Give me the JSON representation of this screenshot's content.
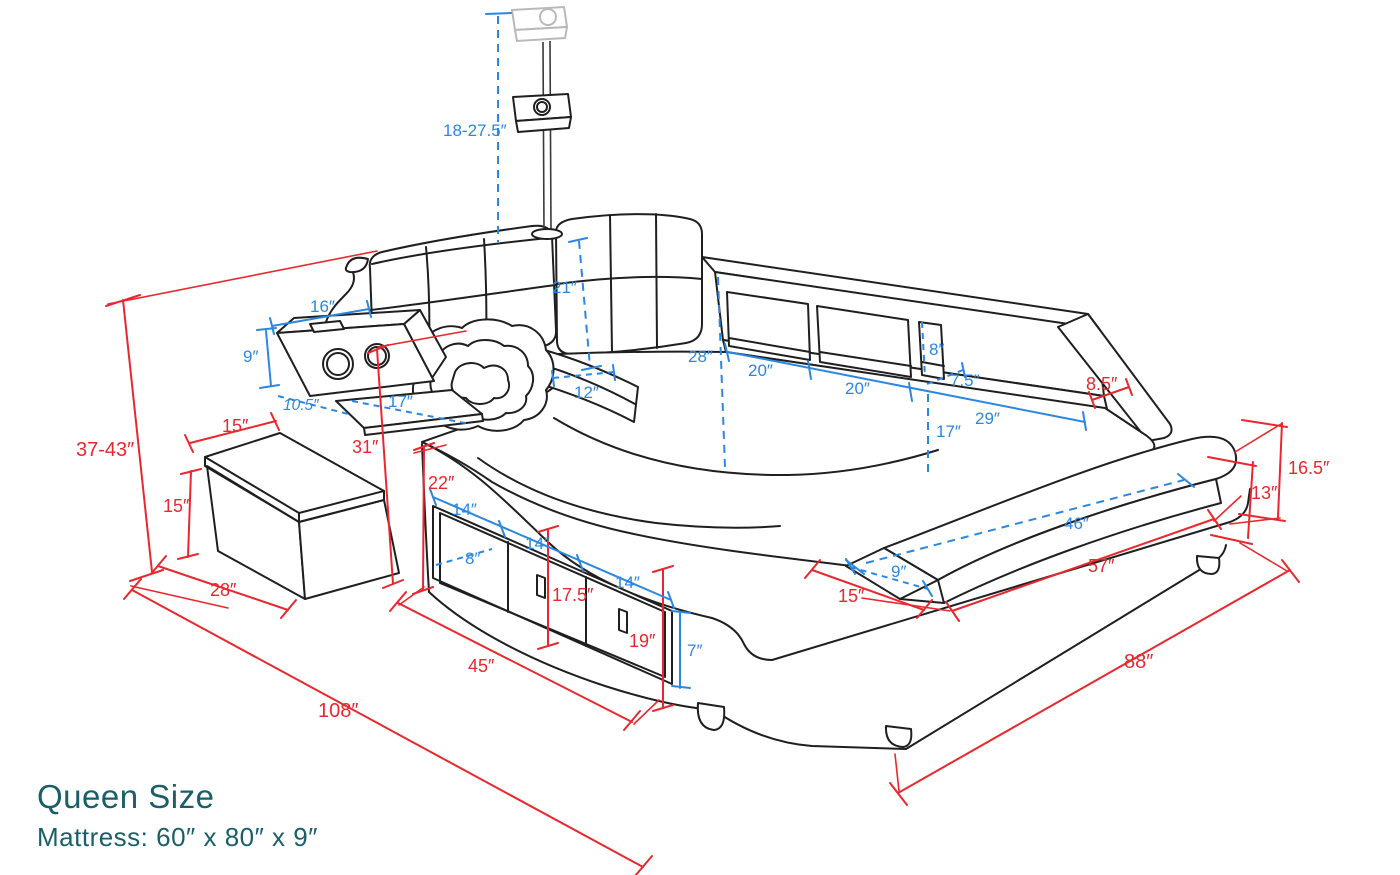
{
  "title": {
    "product": "Queen Size",
    "mattress_spec": "Mattress:  60″  x  80″  x  9″"
  },
  "colors": {
    "dimension_red": "#e8282e",
    "dimension_blue": "#2b87e1",
    "title_teal": "#1a5f68",
    "line_black": "#1f1f1f"
  },
  "dims_blue": {
    "projector_drop": "18-27.5″",
    "headboard_cushion_height": "21″",
    "speaker_shelf_width": "16″",
    "speaker_shelf_height": "9″",
    "speaker_shelf_depth": "10.5″",
    "side_tray_depth": "17″",
    "headrest_width": "12″",
    "mattress_head_width": "28″",
    "shelf_section_1": "20″",
    "shelf_section_2": "20″",
    "cubby_height": "8″",
    "shelf_depth": "7.5″",
    "shelf_section_3": "29″",
    "rail_height": "17″",
    "bench_top_length": "46″",
    "bench_depth": "9″",
    "plinth_height": "7″",
    "drawer_1": "14″",
    "drawer_2": "14″",
    "drawer_3": "14″",
    "drawer_depth": "8″"
  },
  "dims_red": {
    "total_height": "37-43″",
    "ottoman_width": "15″",
    "ottoman_height": "15″",
    "ottoman_depth": "28″",
    "total_length": "108″",
    "side_table_height": "31″",
    "mattress_left_width": "22″",
    "drawer_panel_height": "17.5″",
    "base_height": "19″",
    "drawer_unit_length": "45″",
    "front_gap": "15″",
    "bench_length": "57″",
    "total_width": "88″",
    "rail_top_width": "8.5″",
    "corner_height": "16.5″",
    "platform_height": "13″"
  }
}
